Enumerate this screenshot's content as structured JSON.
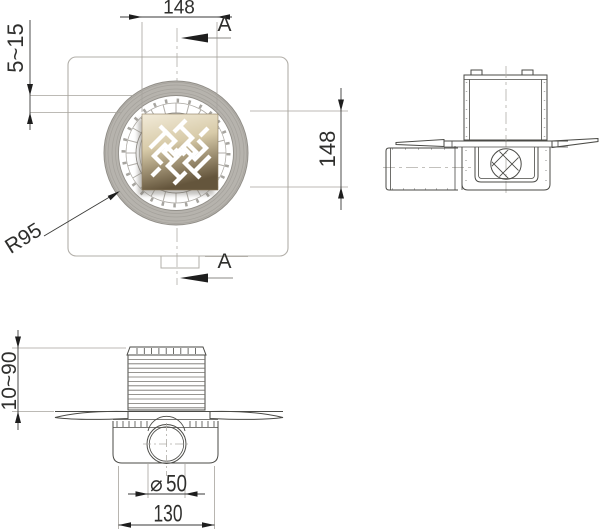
{
  "colors": {
    "line": "#4a4a46",
    "aux_line": "#a6a39d",
    "shading": "#b6b3ad",
    "grate_top": "#f2ebd9",
    "grate_mid": "#d8cba9",
    "grate_bottom": "#64553c"
  },
  "plan_view": {
    "dim_width": "148",
    "dim_height": "148",
    "dim_collar_range": "5~15",
    "dim_radius": "R95",
    "section_label_top": "A",
    "section_label_bottom": "A"
  },
  "front_view": {
    "dim_depth_range": "10~90",
    "dim_outlet_symbol": "⌀",
    "dim_outlet_value": "50",
    "dim_body_width": "130"
  }
}
